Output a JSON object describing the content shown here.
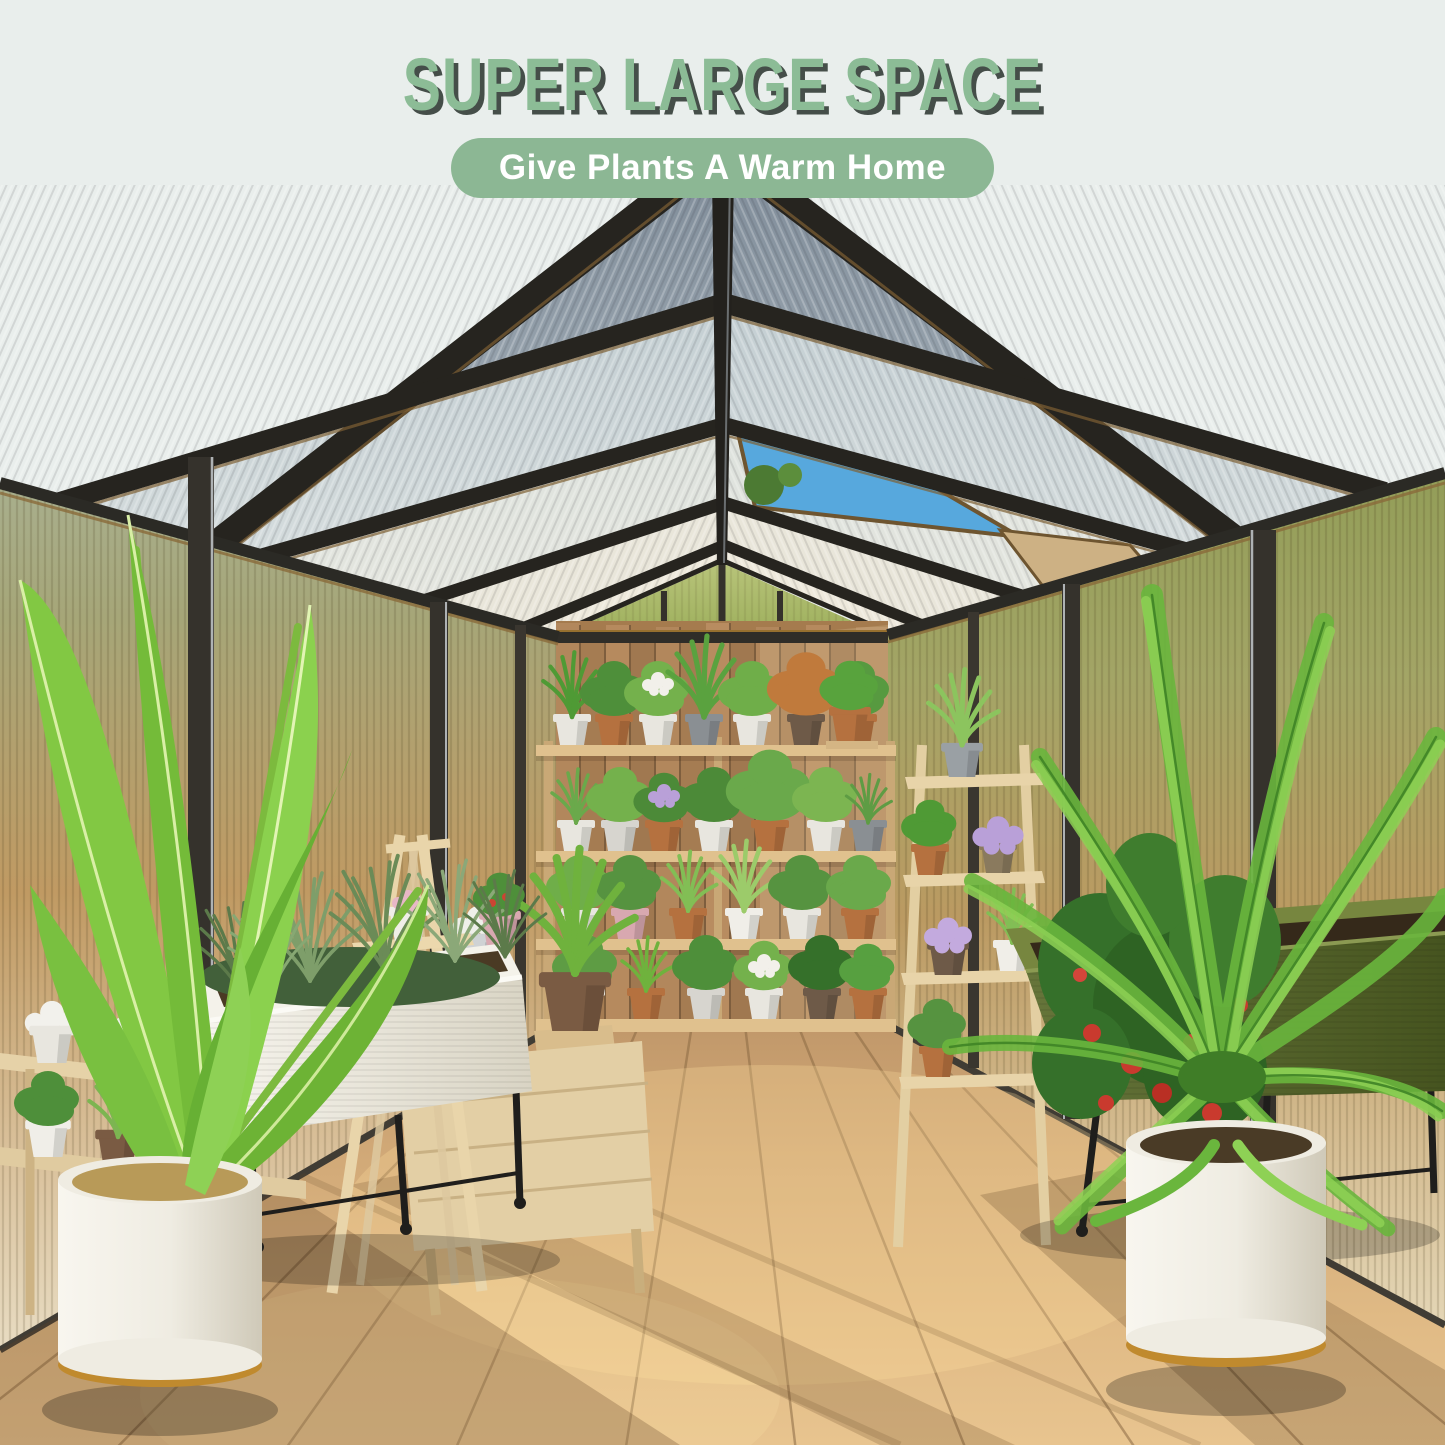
{
  "header": {
    "title": "SUPER LARGE SPACE",
    "subtitle": "Give Plants A Warm Home"
  },
  "palette": {
    "background": "#e9eeec",
    "title_text": "#8cbc96",
    "title_shadow": "#454e49",
    "banner_fill": "#8cb794",
    "banner_text": "#ffffff",
    "frame_dark": "#2b2a25",
    "frame_bronze": "#8a6a3a",
    "roof_panel_near": "#9fb0ba",
    "roof_panel_far": "#ece9e0",
    "sky_blue": "#57a8dd",
    "wall_olive": "#97a355",
    "wall_amber": "#c49a63",
    "fence_wood": "#ab8157",
    "shelf_wood": "#dcbd8c",
    "floor_wood": "#d2a873",
    "planter_white": "#f1efe7",
    "planter_olive": "#5b6a31",
    "pot_gold": "#c08a2e",
    "foliage_green": "#6fbe3c",
    "tomato_red": "#c93a2e",
    "flower_purple": "#b9a0d8"
  }
}
